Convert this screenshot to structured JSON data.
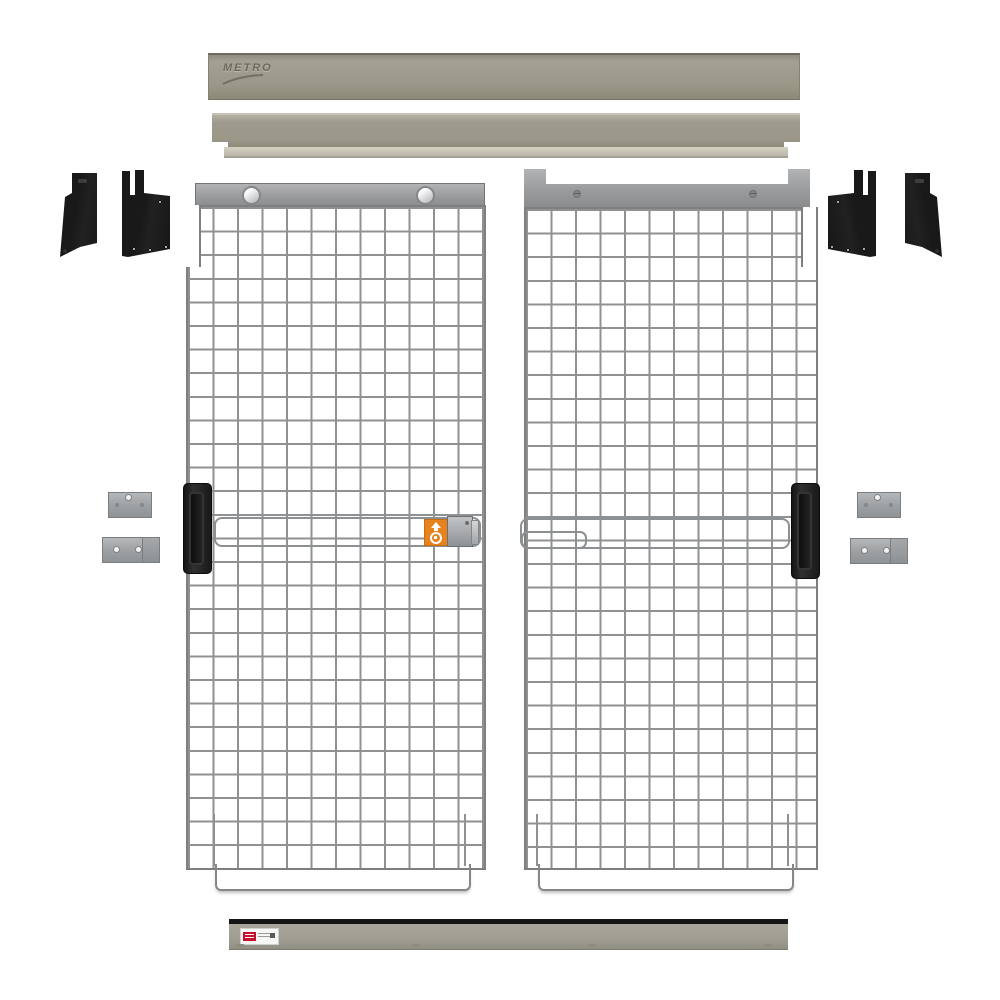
{
  "canvas": {
    "width": 1000,
    "height": 1000,
    "background": "#ffffff"
  },
  "colors": {
    "canvas-bg": "#ffffff",
    "rail-body": "#9b9889",
    "rail-lip": "#d4d1c3",
    "header-metal": "#9b9c9e",
    "mesh-wire": "#8f9193",
    "mesh-frame": "#7d7f81",
    "part-black": "#212121",
    "outline-bar": "#8d9092",
    "orange": "#e8821d",
    "kick-gray": "#a09d92",
    "kick-strip": "#151515",
    "label-red": "#c8102e"
  },
  "branding": {
    "rail_logo": "METRO"
  },
  "parts": {
    "rails": {
      "top_rail_count": 1,
      "track_rail_count": 1
    },
    "corner_brackets_black": 4,
    "wall_brackets_gray": 4,
    "panels": {
      "left": {
        "mesh_cols": 12,
        "mesh_rows": 28,
        "rollers": 2,
        "handle": "recessed-black",
        "lock_bar": true,
        "warning_label": {
          "background": "#e8821d",
          "icons": [
            "up-arrow-icon",
            "padlock-icon"
          ]
        }
      },
      "right": {
        "mesh_cols": 12,
        "mesh_rows": 28,
        "mounting_ears": 2,
        "screws": 2,
        "handle": "recessed-black",
        "lock_bar": true,
        "slot_bar": true
      }
    },
    "kick_plate": {
      "label_brand_color": "#c8102e",
      "feet": 4
    }
  }
}
